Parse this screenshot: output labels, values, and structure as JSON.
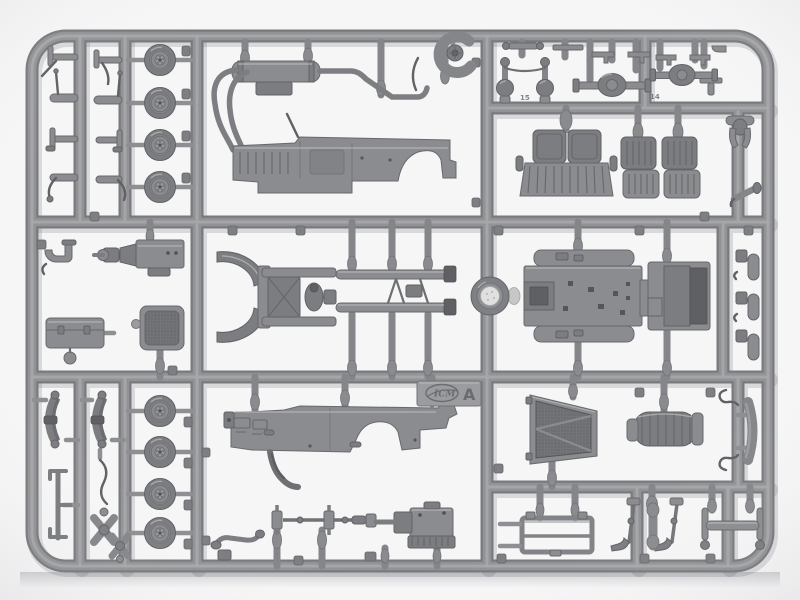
{
  "meta": {
    "type": "photograph",
    "subject": "injection-molded model kit sprue (light gray styrene) with vehicle parts",
    "background_color": "#f6f6f7",
    "plastic_color": "#8b8c8f",
    "runner_shadow_color": "#46464e"
  },
  "sprue": {
    "frame_label": "A",
    "brand_logo": "ICM",
    "embossed_part_numbers": [
      "15",
      "14"
    ]
  },
  "parts": [
    {
      "name": "road-wheel",
      "qty": 8
    },
    {
      "name": "pedal-and-lever-set",
      "qty": 8
    },
    {
      "name": "exhaust-muffler-with-pipes",
      "qty": 1
    },
    {
      "name": "body-side-panel-left",
      "qty": 1
    },
    {
      "name": "horn-coil",
      "qty": 1
    },
    {
      "name": "front-axle-with-kingpins",
      "qty": 1
    },
    {
      "name": "rear-axle-with-differential",
      "qty": 2
    },
    {
      "name": "small-brackets-and-rods",
      "qty": 6
    },
    {
      "name": "bench-seat",
      "qty": 1
    },
    {
      "name": "bucket-seat",
      "qty": 2
    },
    {
      "name": "towing-yoke",
      "qty": 1
    },
    {
      "name": "exhaust-tail-pipe",
      "qty": 1
    },
    {
      "name": "engine-block-assembly",
      "qty": 1
    },
    {
      "name": "pipe-fitting",
      "qty": 1
    },
    {
      "name": "battery-box",
      "qty": 1
    },
    {
      "name": "radiator-core",
      "qty": 1
    },
    {
      "name": "chassis-front-with-fenders",
      "qty": 1
    },
    {
      "name": "chassis-side-rail",
      "qty": 2
    },
    {
      "name": "spare-wheel-disc",
      "qty": 1
    },
    {
      "name": "body-floor-pan-with-running-boards",
      "qty": 1
    },
    {
      "name": "small-cylinder-fitting",
      "qty": 3
    },
    {
      "name": "leaf-spring",
      "qty": 2
    },
    {
      "name": "running-board-support-rod",
      "qty": 1
    },
    {
      "name": "flexible-hose",
      "qty": 1
    },
    {
      "name": "suspension-link-cross",
      "qty": 2
    },
    {
      "name": "body-side-panel-right",
      "qty": 1
    },
    {
      "name": "radiator-shell",
      "qty": 1
    },
    {
      "name": "canvas-tarp-roll",
      "qty": 1
    },
    {
      "name": "bumper-strip",
      "qty": 1
    },
    {
      "name": "stabilizer-bar",
      "qty": 1
    },
    {
      "name": "drive-shaft-with-u-joints",
      "qty": 1
    },
    {
      "name": "engine-oil-pan",
      "qty": 1
    },
    {
      "name": "windshield-frame",
      "qty": 1
    },
    {
      "name": "hand-lever",
      "qty": 2
    },
    {
      "name": "track-rod",
      "qty": 1
    }
  ]
}
